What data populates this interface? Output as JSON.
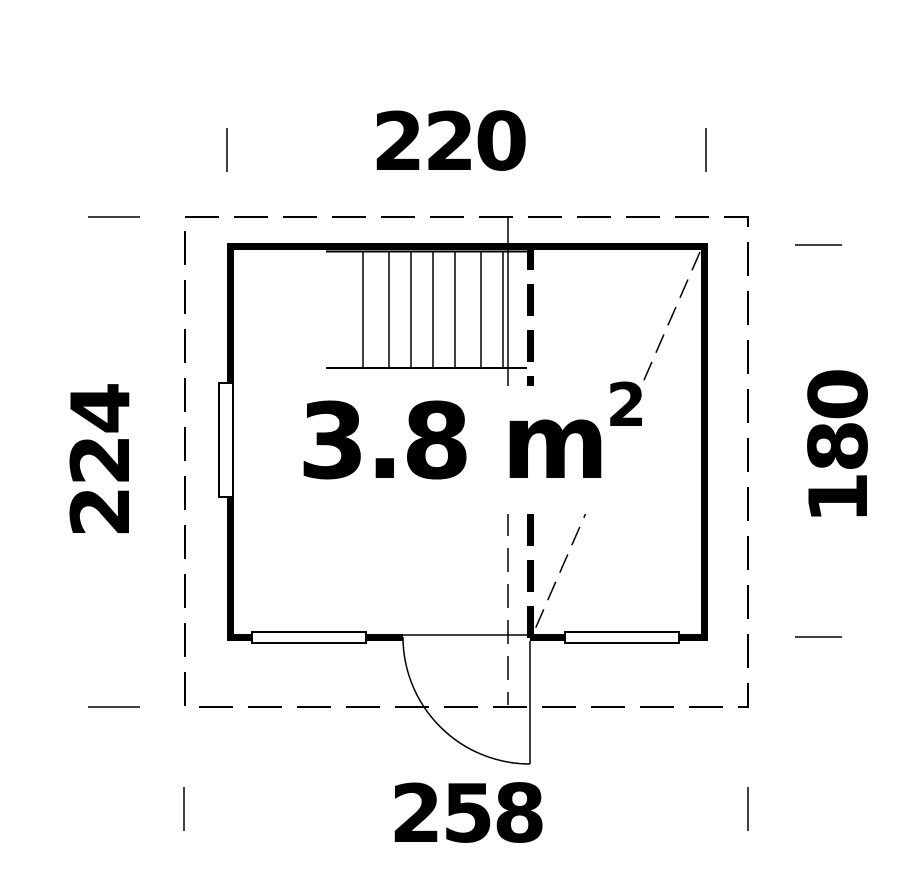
{
  "plan": {
    "area_label": {
      "main": "3.8 m",
      "superscript": "2"
    },
    "dimensions": {
      "top": "220",
      "bottom": "258",
      "left": "224",
      "right": "180"
    },
    "colors": {
      "line": "#000000",
      "background": "#ffffff"
    }
  }
}
